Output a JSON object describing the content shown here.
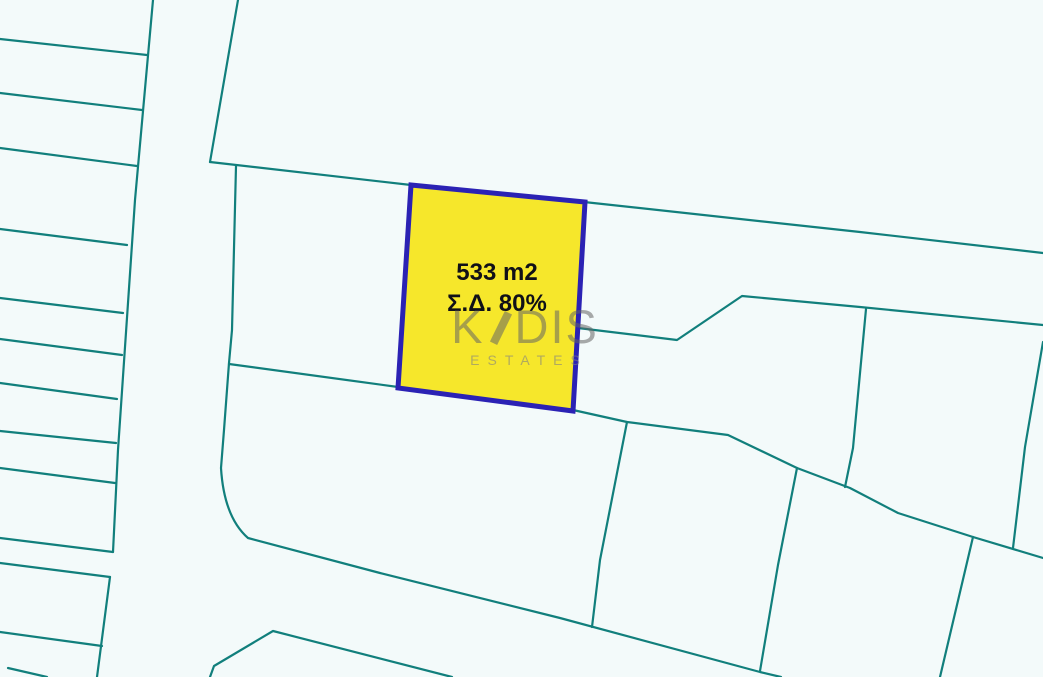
{
  "page": {
    "type": "cadastral-plot-map"
  },
  "map": {
    "background_color": "#f3fafa",
    "boundary_line_color": "#117f7c"
  },
  "plot": {
    "area_label": "533 m2",
    "building_density_label": "Σ.Δ. 80%",
    "fill_color": "#f6e72b",
    "border_color": "#2b22b4",
    "label_color": "#101018"
  },
  "watermark": {
    "brand": "KADIS",
    "brand_prefix": "K",
    "brand_suffix": "DIS",
    "subtitle": "ESTATES",
    "color": "#8a8a8a"
  }
}
